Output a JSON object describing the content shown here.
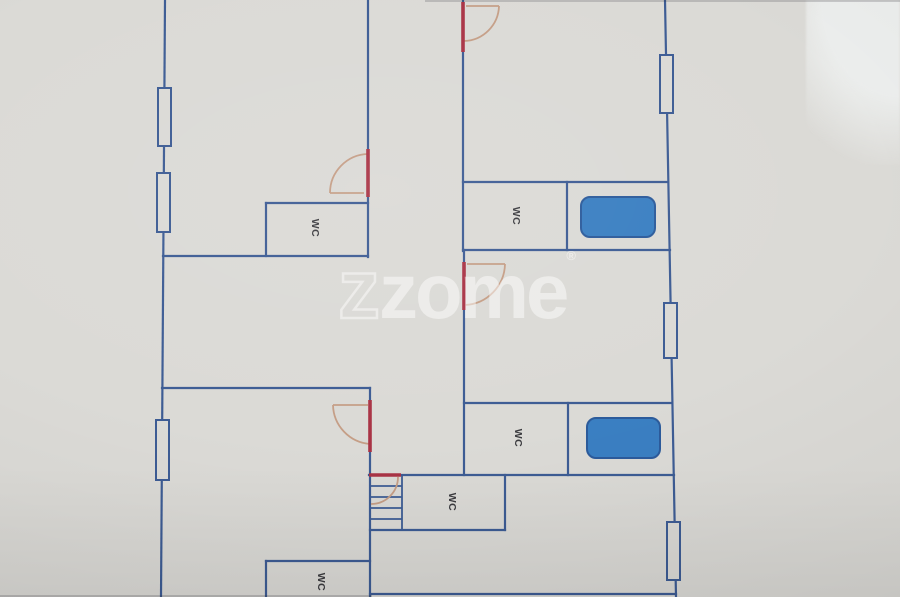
{
  "labels": {
    "wc": "WC"
  },
  "watermark": {
    "outline_letter": "z",
    "word": "zome",
    "registered_mark": "®"
  },
  "colors": {
    "paper": "#dbdad6",
    "wall_blue": "#3d5c94",
    "door_red": "#a93345",
    "door_arc_tan": "#c59e86",
    "tub_fill": "#3a7fc2",
    "tub_stroke": "#2c5b9b",
    "wc_text": "#3b3b3f",
    "watermark_white": "rgba(255,255,255,0.52)"
  }
}
